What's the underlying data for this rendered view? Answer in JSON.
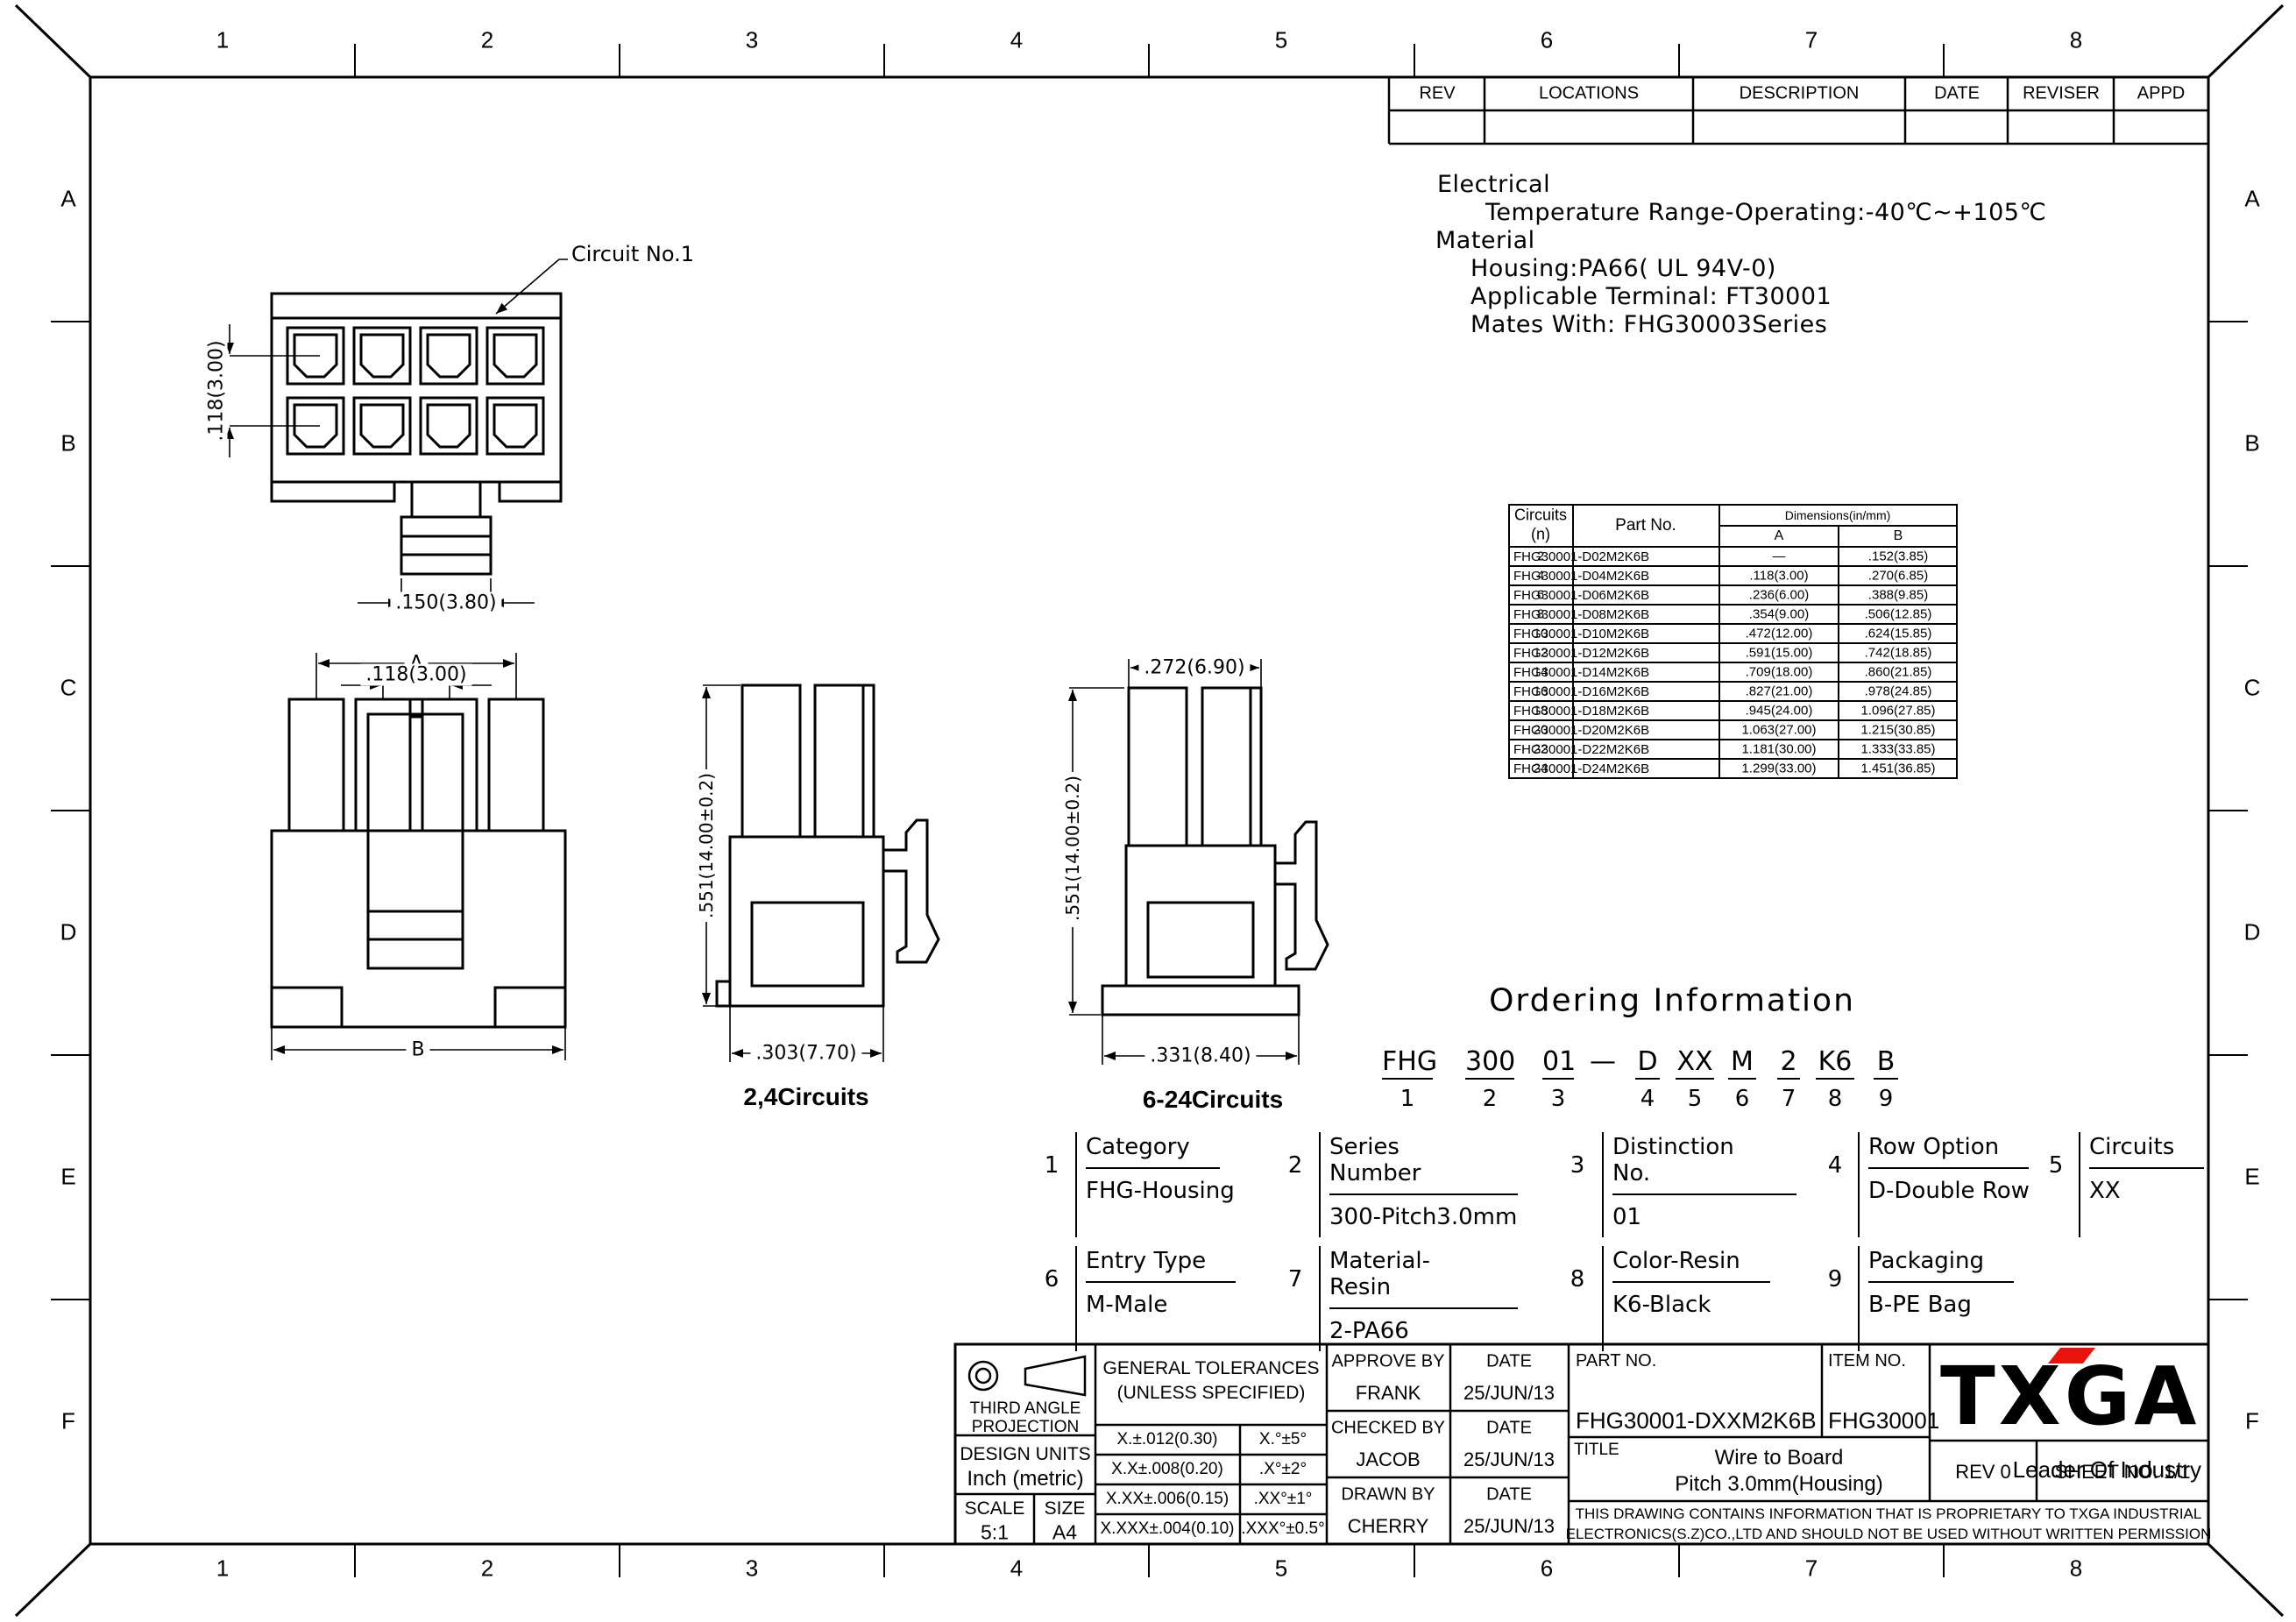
{
  "colors": {
    "line": "#000000",
    "background": "#ffffff",
    "logo_red": "#e8130c"
  },
  "sheet": {
    "columns": [
      "1",
      "2",
      "3",
      "4",
      "5",
      "6",
      "7",
      "8"
    ],
    "rows": [
      "A",
      "B",
      "C",
      "D",
      "E",
      "F"
    ]
  },
  "revision_table": {
    "headers": [
      "REV",
      "LOCATIONS",
      "DESCRIPTION",
      "DATE",
      "REVISER",
      "APPD"
    ]
  },
  "notes": {
    "electrical_heading": "Electrical",
    "temperature": "Temperature Range-Operating:-40℃~+105℃",
    "material_heading": "Material",
    "housing": "Housing:PA66( UL 94V-0)",
    "terminal": "Applicable Terminal: FT30001",
    "mates": "Mates With: FHG30003Series"
  },
  "parts_table": {
    "header": {
      "circuits": "Circuits",
      "circuits_unit": "(n)",
      "part": "Part No.",
      "dims": "Dimensions(in/mm)",
      "a": "A",
      "b": "B"
    },
    "rows": [
      {
        "n": "2",
        "part": "FHG30001-D02M2K6B",
        "a": "—",
        "b": ".152(3.85)"
      },
      {
        "n": "4",
        "part": "FHG30001-D04M2K6B",
        "a": ".118(3.00)",
        "b": ".270(6.85)"
      },
      {
        "n": "6",
        "part": "FHG30001-D06M2K6B",
        "a": ".236(6.00)",
        "b": ".388(9.85)"
      },
      {
        "n": "8",
        "part": "FHG30001-D08M2K6B",
        "a": ".354(9.00)",
        "b": ".506(12.85)"
      },
      {
        "n": "10",
        "part": "FHG30001-D10M2K6B",
        "a": ".472(12.00)",
        "b": ".624(15.85)"
      },
      {
        "n": "12",
        "part": "FHG30001-D12M2K6B",
        "a": ".591(15.00)",
        "b": ".742(18.85)"
      },
      {
        "n": "14",
        "part": "FHG30001-D14M2K6B",
        "a": ".709(18.00)",
        "b": ".860(21.85)"
      },
      {
        "n": "16",
        "part": "FHG30001-D16M2K6B",
        "a": ".827(21.00)",
        "b": ".978(24.85)"
      },
      {
        "n": "18",
        "part": "FHG30001-D18M2K6B",
        "a": ".945(24.00)",
        "b": "1.096(27.85)"
      },
      {
        "n": "20",
        "part": "FHG30001-D20M2K6B",
        "a": "1.063(27.00)",
        "b": "1.215(30.85)"
      },
      {
        "n": "22",
        "part": "FHG30001-D22M2K6B",
        "a": "1.181(30.00)",
        "b": "1.333(33.85)"
      },
      {
        "n": "24",
        "part": "FHG30001-D24M2K6B",
        "a": "1.299(33.00)",
        "b": "1.451(36.85)"
      }
    ]
  },
  "drawing": {
    "circuit_label": "Circuit No.1",
    "face_pitch": ".118(3.00)",
    "face_latch": ".150(3.80)",
    "front_a": "A",
    "front_pitch": ".118(3.00)",
    "front_b": "B",
    "side_height": ".551(14.00±0.2)",
    "side24_width": ".303(7.70)",
    "side24_caption": "2,4Circuits",
    "side624_top": ".272(6.90)",
    "side624_height": ".551(14.00±0.2)",
    "side624_width": ".331(8.40)",
    "side624_caption": "6-24Circuits"
  },
  "ordering": {
    "title": "Ordering Information",
    "codes": [
      "FHG",
      "300",
      "01",
      "—",
      "D",
      "XX",
      "M",
      "2",
      "K6",
      "B"
    ],
    "digits": [
      "1",
      "2",
      "3",
      "4",
      "5",
      "6",
      "7",
      "8",
      "9"
    ],
    "items": [
      {
        "no": "1",
        "label": "Category",
        "value": "FHG-Housing"
      },
      {
        "no": "2",
        "label": "Series Number",
        "value": "300-Pitch3.0mm"
      },
      {
        "no": "3",
        "label": "Distinction No.",
        "value": "01"
      },
      {
        "no": "4",
        "label": "Row Option",
        "value": "D-Double Row"
      },
      {
        "no": "5",
        "label": "Circuits",
        "value": "XX"
      },
      {
        "no": "6",
        "label": "Entry Type",
        "value": "M-Male"
      },
      {
        "no": "7",
        "label": "Material-Resin",
        "value": "2-PA66"
      },
      {
        "no": "8",
        "label": "Color-Resin",
        "value": "K6-Black"
      },
      {
        "no": "9",
        "label": "Packaging",
        "value": "B-PE Bag"
      }
    ]
  },
  "title_block": {
    "third_angle_1": "THIRD ANGLE",
    "third_angle_2": "PROJECTION",
    "design_units_label": "DESIGN UNITS",
    "design_units_value": "Inch (metric)",
    "scale_label": "SCALE",
    "scale_value": "5:1",
    "size_label": "SIZE",
    "size_value": "A4",
    "tol_title_1": "GENERAL TOLERANCES",
    "tol_title_2": "(UNLESS SPECIFIED)",
    "tol": [
      {
        "lin": "X.±.012(0.30)",
        "ang": "X.°±5°"
      },
      {
        "lin": "X.X±.008(0.20)",
        "ang": ".X°±2°"
      },
      {
        "lin": "X.XX±.006(0.15)",
        "ang": ".XX°±1°"
      },
      {
        "lin": "X.XXX±.004(0.10)",
        "ang": ".XXX°±0.5°"
      }
    ],
    "approve_label": "APPROVE BY",
    "approve_name": "FRANK",
    "approve_date": "25/JUN/13",
    "checked_label": "CHECKED BY",
    "checked_name": "JACOB",
    "checked_date": "25/JUN/13",
    "drawn_label": "DRAWN BY",
    "drawn_name": "CHERRY",
    "drawn_date": "25/JUN/13",
    "date_label": "DATE",
    "part_no_label": "PART NO.",
    "part_no": "FHG30001-DXXM2K6B",
    "item_no_label": "ITEM NO.",
    "item_no": "FHG30001",
    "title_label": "TITLE",
    "title_line1": "Wire to Board",
    "title_line2": "Pitch 3.0mm(Housing)",
    "rev": "REV 0",
    "sheet_no": "SHEET NO. 1/1",
    "logo": "TXGA",
    "slogan": "Leader Of Industry",
    "notice_line1": "THIS DRAWING CONTAINS INFORMATION THAT IS PROPRIETARY TO TXGA INDUSTRIAL",
    "notice_line2": "ELECTRONICS(S.Z)CO.,LTD AND SHOULD NOT BE USED WITHOUT WRITTEN PERMISSION"
  }
}
